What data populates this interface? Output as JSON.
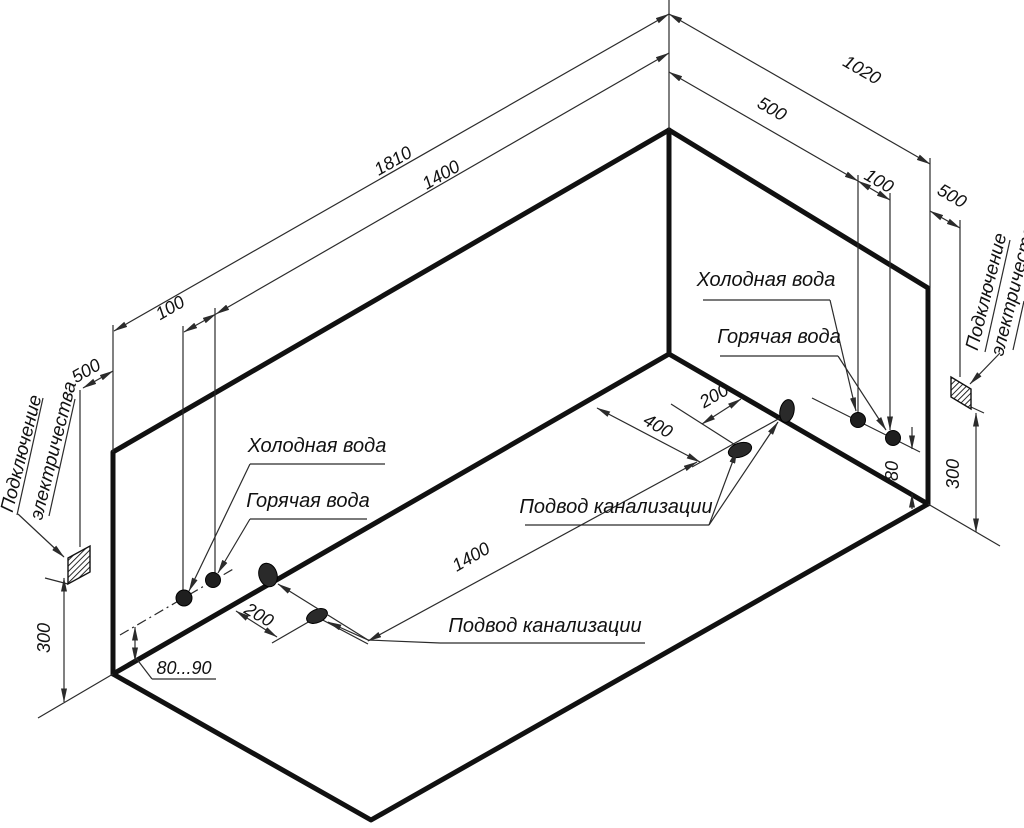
{
  "drawing": {
    "title": "Bathtub installation connection scheme (isometric room corner)",
    "dimensions": {
      "length_top": "1810",
      "hot_water_from_corner_left": "1400",
      "water_spacing_left": "100",
      "electric_offset_left": "500",
      "width_top": "1020",
      "cold_water_from_corner_right": "500",
      "water_spacing_right": "100",
      "electric_offset_right": "500",
      "electric_height_left": "300",
      "electric_height_right": "300",
      "supply_height_left": "80...90",
      "supply_height_right": "80",
      "drain_offset_left": "200",
      "drain_offset_right": "200",
      "wall_drain_offset": "400",
      "drains_distance": "1400"
    },
    "labels": {
      "cold_water_left": "Холодная вода",
      "hot_water_left": "Горячая вода",
      "cold_water_right": "Холодная вода",
      "hot_water_right": "Горячая вода",
      "sewage_left": "Подвод канализации",
      "sewage_mid": "Подвод канализации",
      "electric_line1": "Подключение",
      "electric_line2": "электричества"
    },
    "colors": {
      "line": "#111111",
      "thin_line": "#2b2b2b",
      "background": "#ffffff"
    }
  }
}
